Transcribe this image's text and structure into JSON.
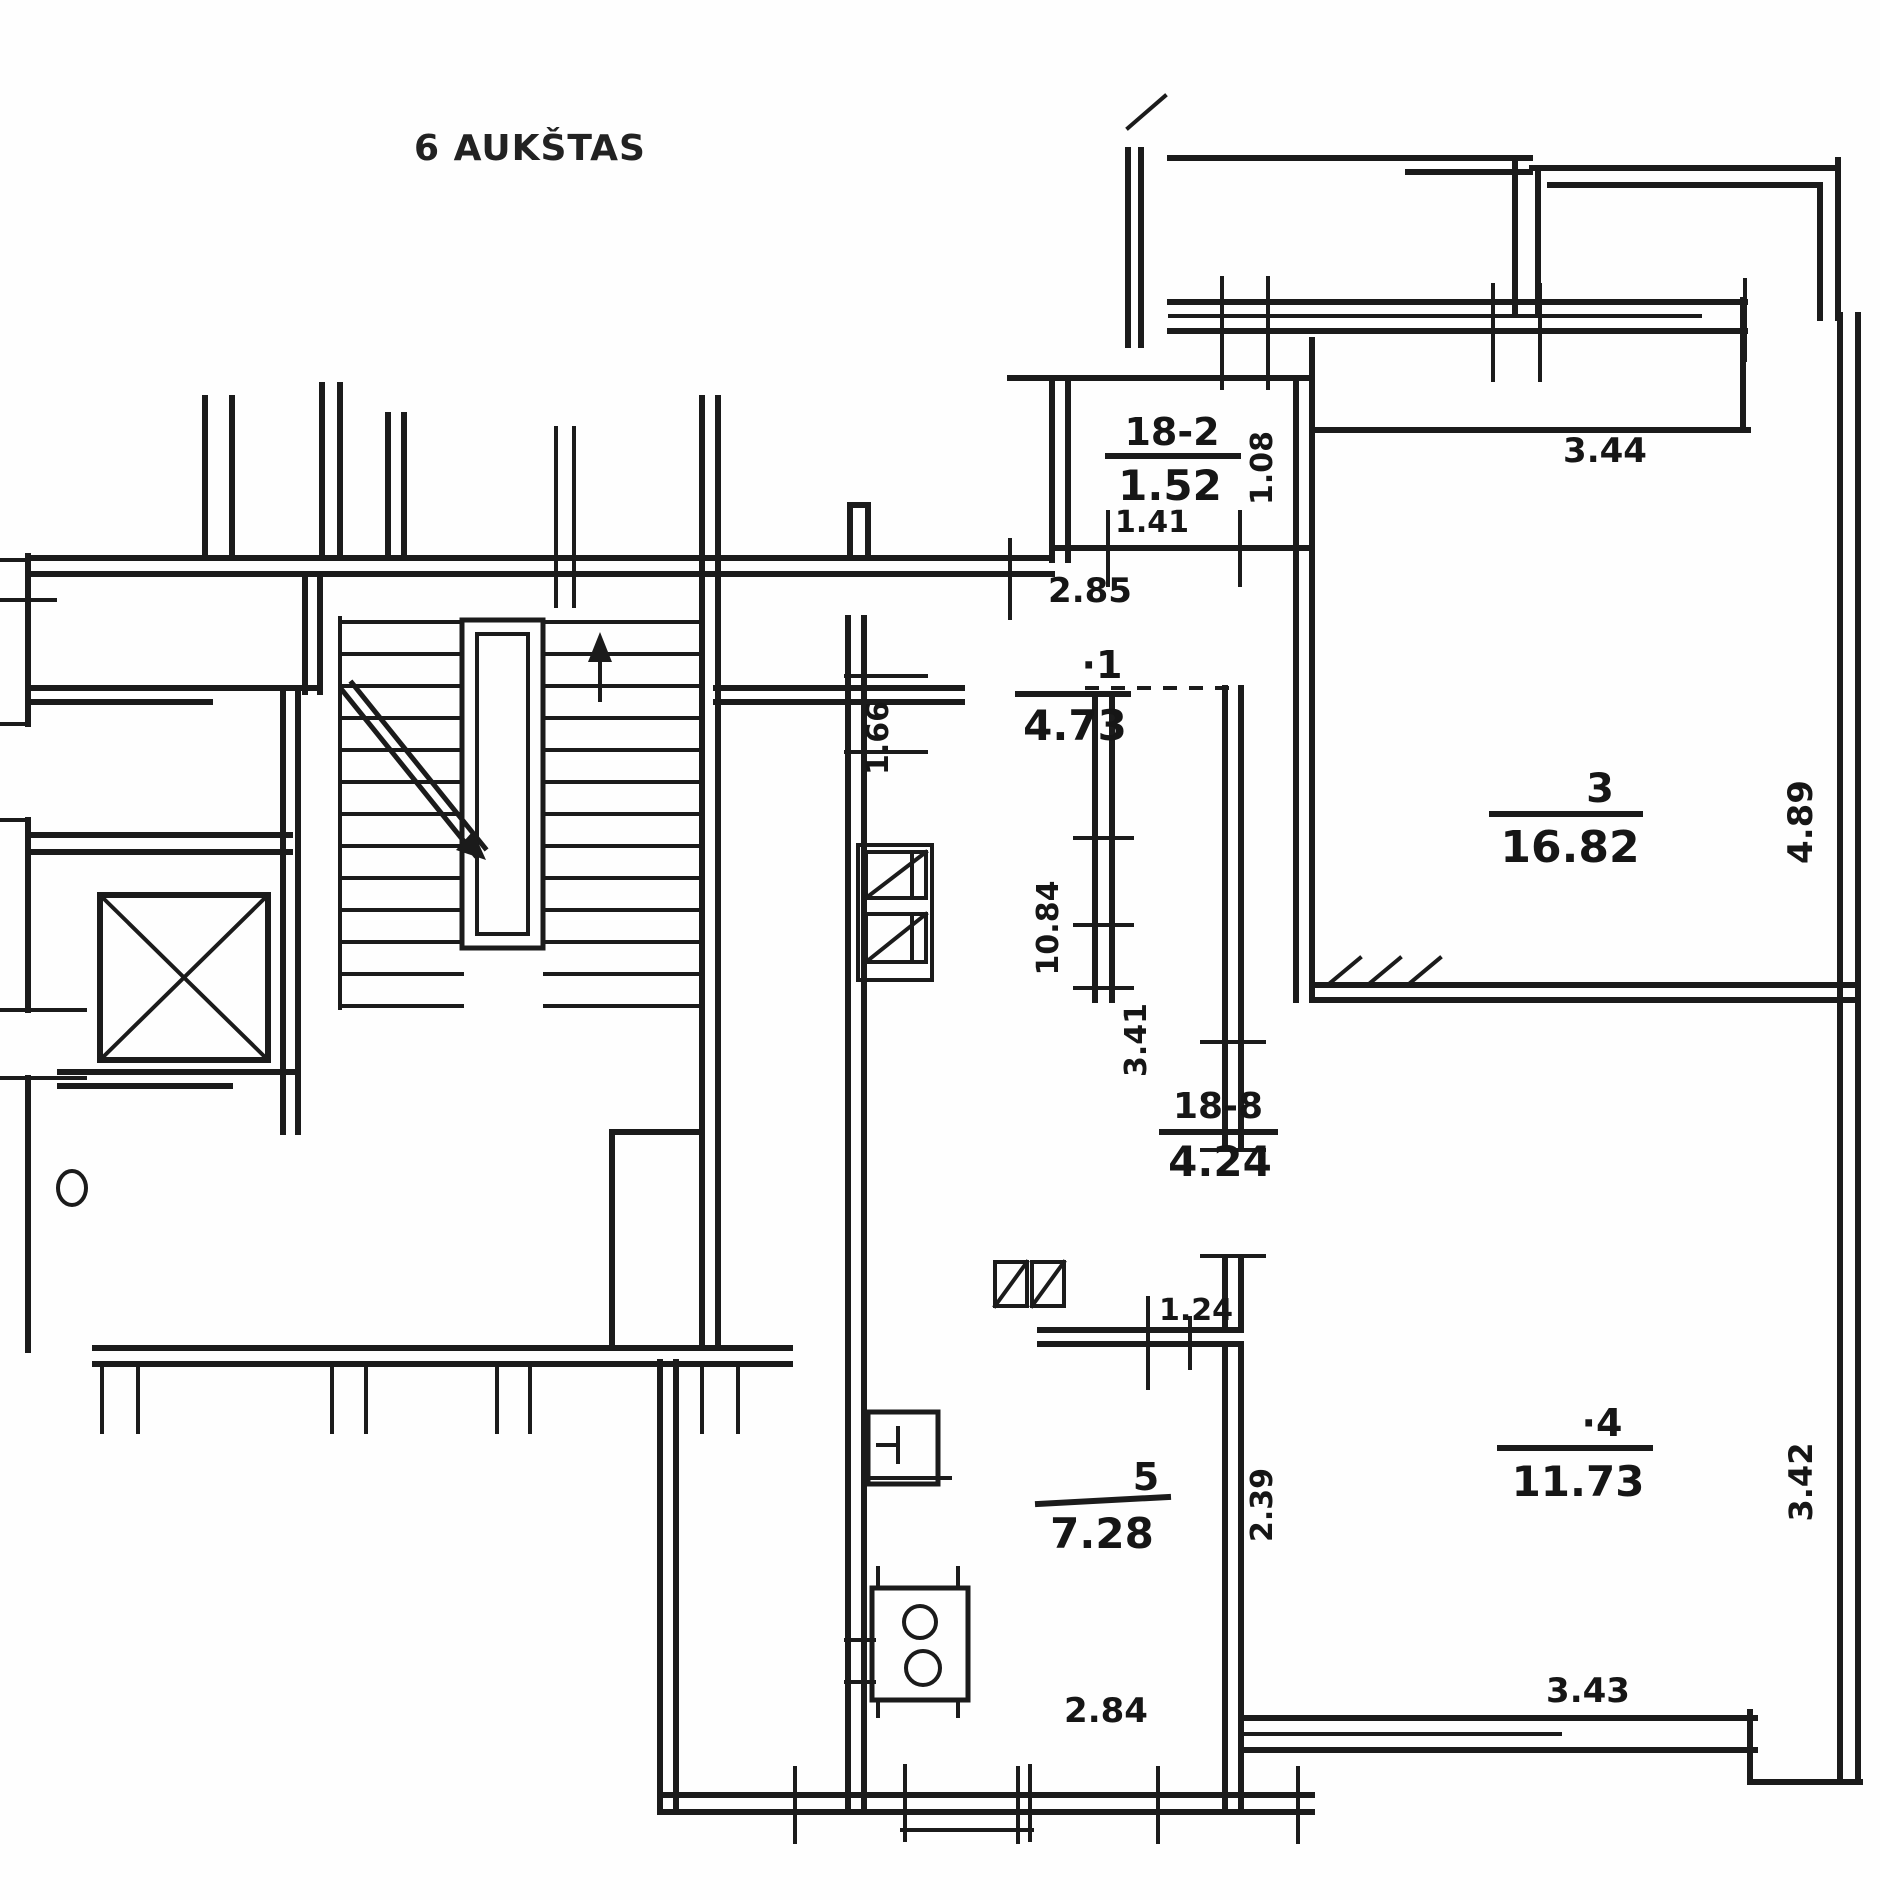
{
  "header": {
    "title": "6 AUKŠTAS"
  },
  "plan": {
    "type": "apartment floor plan, scanned hand-drawn blueprint",
    "floor_number": "6"
  },
  "rooms": {
    "vestibule": {
      "id": "18-2",
      "area": "1.52"
    },
    "hall": {
      "id": "·1",
      "area": "4.73"
    },
    "living": {
      "id": "3",
      "area": "16.82"
    },
    "corridor": {
      "id": "18-8",
      "area": "4.24"
    },
    "bedroom": {
      "id": "·4",
      "area": "11.73"
    },
    "kitchen": {
      "id": "5",
      "area": "7.28"
    }
  },
  "dimensions": {
    "vestibule_width": "1.41",
    "vestibule_side": "1.08",
    "hall_width": "2.85",
    "hall_side": "1.66",
    "living_top": "3.44",
    "living_side": "4.89",
    "corridor_top_side": "10.84",
    "corridor_side": "3.41",
    "corridor_opening": "1.24",
    "bedroom_left_side": "2.39",
    "bedroom_right_side": "3.42",
    "bedroom_bottom": "3.43",
    "kitchen_bottom": "2.84"
  }
}
